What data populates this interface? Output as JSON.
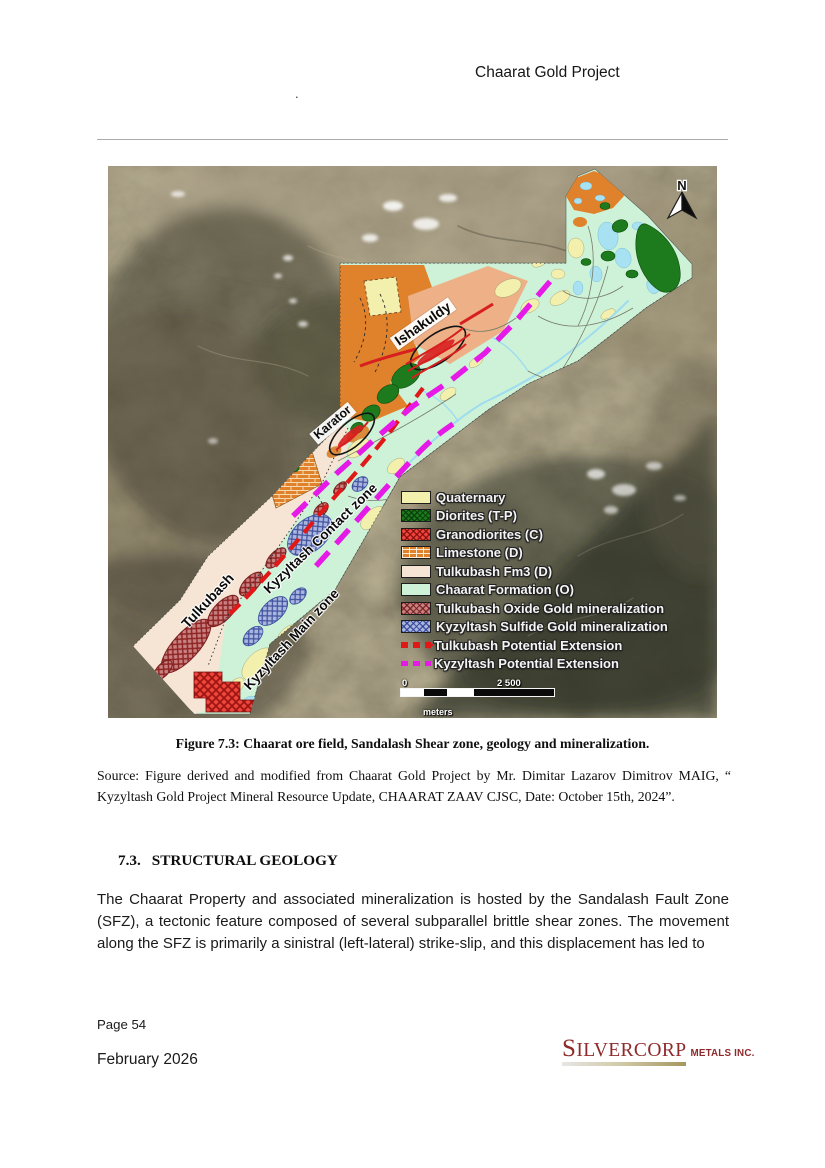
{
  "header": {
    "title": "Chaarat Gold Project",
    "stray_mark": "."
  },
  "figure": {
    "caption": "Figure 7.3: Chaarat ore field, Sandalash Shear zone, geology and mineralization.",
    "source_text": "Source: Figure derived and modified from Chaarat Gold Project by Mr. Dimitar Lazarov Dimitrov MAIG,  “ Kyzyltash Gold Project Mineral Resource Update, CHAARAT ZAAV CJSC, Date: October 15th, 2024”.",
    "map": {
      "north_label": "N",
      "area_labels": [
        {
          "text": "Ishakuldy"
        },
        {
          "text": "Karator"
        },
        {
          "text": "Tulkubash"
        },
        {
          "text": "Kyzyltash Contact zone"
        },
        {
          "text": "Kyzyltash Main zone"
        }
      ],
      "legend": {
        "items": [
          {
            "label": "Quaternary",
            "color": "#f3f0ae",
            "symbol": "solid"
          },
          {
            "label": "Diorites (T-P)",
            "color": "#1d7a1d",
            "symbol": "crosshatch"
          },
          {
            "label": "Granodiorites (C)",
            "color": "#ee453c",
            "symbol": "crosshatch"
          },
          {
            "label": "Limestone (D)",
            "color": "#e0812b",
            "symbol": "brick"
          },
          {
            "label": "Tulkubash Fm3 (D)",
            "color": "#f6e4d4",
            "symbol": "solid"
          },
          {
            "label": "Chaarat Formation (O)",
            "color": "#cdf2d8",
            "symbol": "solid"
          },
          {
            "label": "Tulkubash Oxide Gold mineralization",
            "color": "#c98080",
            "symbol": "crosshatch"
          },
          {
            "label": "Kyzyltash Sulfide Gold mineralization",
            "color": "#aab6e0",
            "symbol": "crosshatch"
          },
          {
            "label": "Tulkubash Potential Extension",
            "color": "#e01818",
            "symbol": "dashed-line-arrow"
          },
          {
            "label": "Kyzyltash Potential Extension",
            "color": "#e61ae6",
            "symbol": "dashed-line"
          }
        ],
        "scale_bar": {
          "start_label": "0",
          "end_label": "2 500",
          "unit_label": "meters"
        }
      }
    }
  },
  "section_heading": {
    "number": "7.3.",
    "title": "STRUCTURAL GEOLOGY"
  },
  "body_text": "The Chaarat Property and associated mineralization is hosted by the Sandalash Fault Zone (SFZ), a tectonic feature composed of several subparallel brittle shear zones. The movement along the SFZ is primarily a sinistral (left-lateral) strike-slip, and this displacement has led to",
  "footer": {
    "page_label": "Page 54",
    "date_label": "February 2026",
    "logo": {
      "primary": "SILVERCORP",
      "secondary": "METALS INC.",
      "brand_color": "#8e2a2b"
    }
  }
}
